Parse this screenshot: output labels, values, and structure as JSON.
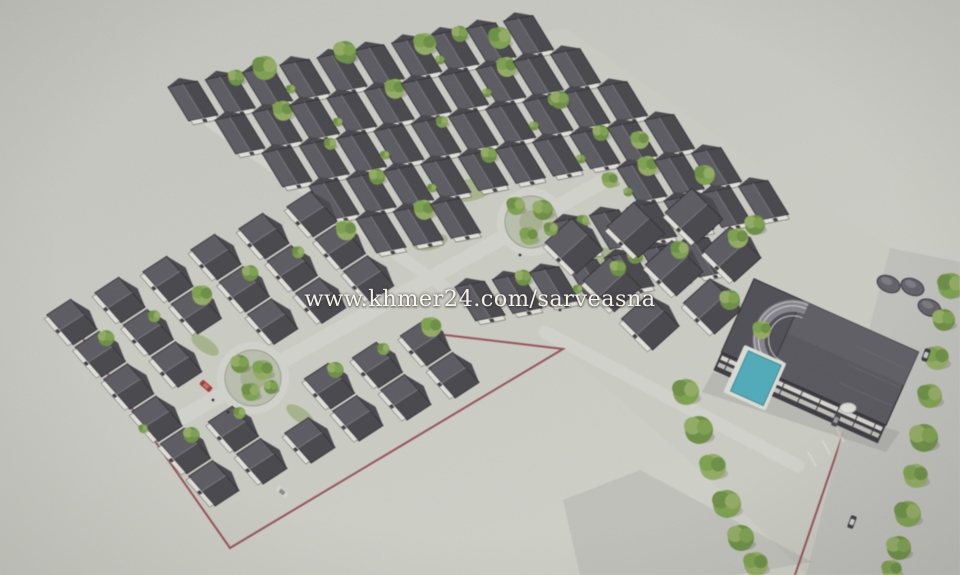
{
  "watermark": {
    "text": "www.khmer24.com/sarveasna"
  },
  "palette": {
    "ground": "#cdcec6",
    "street": "#d5d6ce",
    "road": "#c2c3be",
    "red": "#8e3a43",
    "roofL": "#5b5a61",
    "roofR": "#46454b",
    "roofEdge": "#2e2d32",
    "ridge": "#77767d",
    "wall": "#e4e3dc",
    "g1": "#7da24e",
    "g2": "#6b9143",
    "g3": "#94ae62",
    "pool": "#4fadbc",
    "deck": "#e0e0da",
    "win": "#d9d8d1",
    "people": "#303036"
  },
  "scene": {
    "estate": [
      [
        193,
        100
      ],
      [
        566,
        28
      ],
      [
        801,
        195
      ],
      [
        913,
        262
      ],
      [
        807,
        575
      ],
      [
        700,
        470
      ],
      [
        563,
        349
      ],
      [
        230,
        548
      ],
      [
        70,
        320
      ],
      [
        318,
        210
      ]
    ],
    "mats": {
      "U": [
        0.981,
        -0.192,
        0.52,
        0.85
      ],
      "L": [
        0.66,
        0.75,
        -0.8,
        0.52
      ],
      "M": [
        0.707,
        0.707,
        -0.74,
        0.67
      ]
    },
    "rows": [
      {
        "m": "U",
        "o": [
          193,
          101
        ],
        "n": 10,
        "s": 38,
        "w": 15,
        "d": 20
      },
      {
        "m": "U",
        "o": [
          240,
          134
        ],
        "n": 10,
        "s": 38,
        "w": 15,
        "d": 20
      },
      {
        "m": "U",
        "o": [
          287,
          167
        ],
        "n": 10,
        "s": 38,
        "w": 15,
        "d": 20
      },
      {
        "m": "U",
        "o": [
          334,
          200
        ],
        "n": 10,
        "s": 38,
        "w": 15,
        "d": 20
      },
      {
        "m": "U",
        "o": [
          381,
          233
        ],
        "n": 10,
        "s": 38,
        "w": 15,
        "d": 20
      },
      {
        "m": "U",
        "o": [
          428,
          266
        ],
        "n": 10,
        "s": 38,
        "w": 15,
        "d": 20
      },
      {
        "m": "U",
        "o": [
          480,
          301
        ],
        "n": 7,
        "s": 38,
        "w": 15,
        "d": 20
      },
      {
        "m": "M",
        "o": [
          694,
          216
        ],
        "n": 2,
        "s": 54,
        "w": 22,
        "d": 18
      },
      {
        "m": "M",
        "o": [
          636,
          230
        ],
        "n": 3,
        "s": 54,
        "w": 22,
        "d": 18
      },
      {
        "m": "M",
        "o": [
          574,
          246
        ],
        "n": 3,
        "s": 54,
        "w": 22,
        "d": 18
      },
      {
        "m": "L",
        "o": [
          312,
          214
        ],
        "n": 6,
        "s": 43,
        "w": 20,
        "d": 15
      },
      {
        "m": "L",
        "o": [
          264,
          236
        ],
        "n": 6,
        "s": 43,
        "w": 20,
        "d": 15
      },
      {
        "m": "L",
        "o": [
          216,
          257
        ],
        "n": 6,
        "s": 43,
        "w": 20,
        "d": 15
      },
      {
        "m": "L",
        "o": [
          168,
          279
        ],
        "n": 6,
        "s": 43,
        "w": 20,
        "d": 15
      },
      {
        "m": "L",
        "o": [
          120,
          300
        ],
        "n": 6,
        "s": 43,
        "w": 20,
        "d": 15
      },
      {
        "m": "L",
        "o": [
          72,
          322
        ],
        "n": 6,
        "s": 43,
        "w": 20,
        "d": 15
      }
    ],
    "clear": [
      [
        531,
        222,
        48
      ],
      [
        253,
        378,
        50
      ]
    ],
    "clearSeg": {
      "a": [
        600,
        183
      ],
      "b": [
        170,
        424
      ],
      "r": 13
    },
    "streets": [
      {
        "a": [
          600,
          183
        ],
        "b": [
          170,
          424
        ],
        "w": 15
      },
      {
        "a": [
          545,
          332
        ],
        "b": [
          798,
          466
        ],
        "w": 13
      },
      {
        "a": [
          205,
          118
        ],
        "b": [
          445,
          288
        ],
        "w": 12
      }
    ],
    "roundabouts": [
      {
        "c": [
          531,
          222
        ],
        "r": 26
      },
      {
        "c": [
          253,
          378
        ],
        "r": 28
      }
    ],
    "greens": [
      [
        470,
        190,
        26,
        11,
        -12
      ],
      [
        590,
        258,
        24,
        10,
        -12
      ],
      [
        430,
        242,
        18,
        8,
        -12
      ],
      [
        205,
        345,
        16,
        7,
        35
      ],
      [
        300,
        415,
        16,
        7,
        35
      ]
    ],
    "red_lines": [
      [
        [
          420,
          332
        ],
        [
          563,
          349
        ],
        [
          230,
          548
        ],
        [
          70,
          320
        ]
      ],
      [
        [
          858,
          390
        ],
        [
          795,
          575
        ]
      ]
    ],
    "road": [
      [
        890,
        248
      ],
      [
        960,
        262
      ],
      [
        960,
        575
      ],
      [
        806,
        575
      ]
    ],
    "ticks": {
      "o": [
        808,
        452
      ],
      "step": [
        14,
        -12
      ],
      "d": [
        8,
        14
      ],
      "n": 4
    },
    "shadow": [
      [
        640,
        470
      ],
      [
        812,
        562
      ],
      [
        735,
        575
      ],
      [
        580,
        575
      ],
      [
        563,
        500
      ]
    ],
    "building_shadow": [
      [
        713,
        372
      ],
      [
        900,
        432
      ],
      [
        886,
        452
      ],
      [
        702,
        392
      ]
    ],
    "building": {
      "c": [
        820,
        352
      ],
      "rot": 24
    },
    "domes": [
      [
        35,
        -90
      ],
      [
        58,
        -97
      ],
      [
        82,
        -85
      ]
    ],
    "planter": [
      848,
      408
    ],
    "trees": {
      "road": [
        [
          951,
          286,
          13
        ],
        [
          944,
          320,
          11
        ],
        [
          937,
          358,
          12
        ],
        [
          930,
          396,
          12
        ],
        [
          924,
          438,
          14
        ],
        [
          916,
          476,
          12
        ],
        [
          908,
          514,
          13
        ],
        [
          899,
          548,
          12
        ],
        [
          892,
          570,
          10
        ]
      ],
      "edge": [
        [
          686,
          392,
          13
        ],
        [
          699,
          430,
          14
        ],
        [
          713,
          467,
          13
        ],
        [
          727,
          504,
          14
        ],
        [
          741,
          538,
          13
        ],
        [
          756,
          564,
          12
        ]
      ],
      "scatter": [
        [
          265,
          68,
          12
        ],
        [
          345,
          52,
          11
        ],
        [
          425,
          44,
          11
        ],
        [
          500,
          38,
          11
        ],
        [
          560,
          100,
          9
        ],
        [
          640,
          140,
          9
        ],
        [
          705,
          175,
          10
        ],
        [
          755,
          225,
          10
        ],
        [
          610,
          180,
          8
        ],
        [
          680,
          250,
          9
        ],
        [
          730,
          300,
          10
        ],
        [
          762,
          330,
          9
        ]
      ],
      "c1": [
        [
          516,
          206,
          9
        ],
        [
          543,
          210,
          10
        ],
        [
          529,
          236,
          9
        ],
        [
          551,
          229,
          7
        ]
      ],
      "c2": [
        [
          240,
          364,
          9
        ],
        [
          263,
          370,
          10
        ],
        [
          251,
          392,
          9
        ],
        [
          271,
          387,
          7
        ]
      ]
    },
    "cars": [
      {
        "p": [
          206,
          386
        ],
        "rot": 41,
        "body": "#a63434",
        "top": "#c96b6b"
      },
      {
        "p": [
          926,
          355
        ],
        "rot": 110,
        "body": "#36363c",
        "top": "#caccc8"
      },
      {
        "p": [
          852,
          522
        ],
        "rot": 110,
        "body": "#3a3a40",
        "top": "#d6d6d2"
      },
      {
        "p": [
          836,
          420
        ],
        "rot": 114,
        "body": "#45454b",
        "top": "#9a9aa0"
      },
      {
        "p": [
          282,
          492
        ],
        "rot": 41,
        "body": "#d8d8d2",
        "top": "#8a8a90"
      }
    ],
    "people": [
      [
        520,
        255
      ],
      [
        545,
        268
      ],
      [
        213,
        400
      ],
      [
        228,
        412
      ],
      [
        498,
        302
      ],
      [
        560,
        310
      ]
    ]
  }
}
